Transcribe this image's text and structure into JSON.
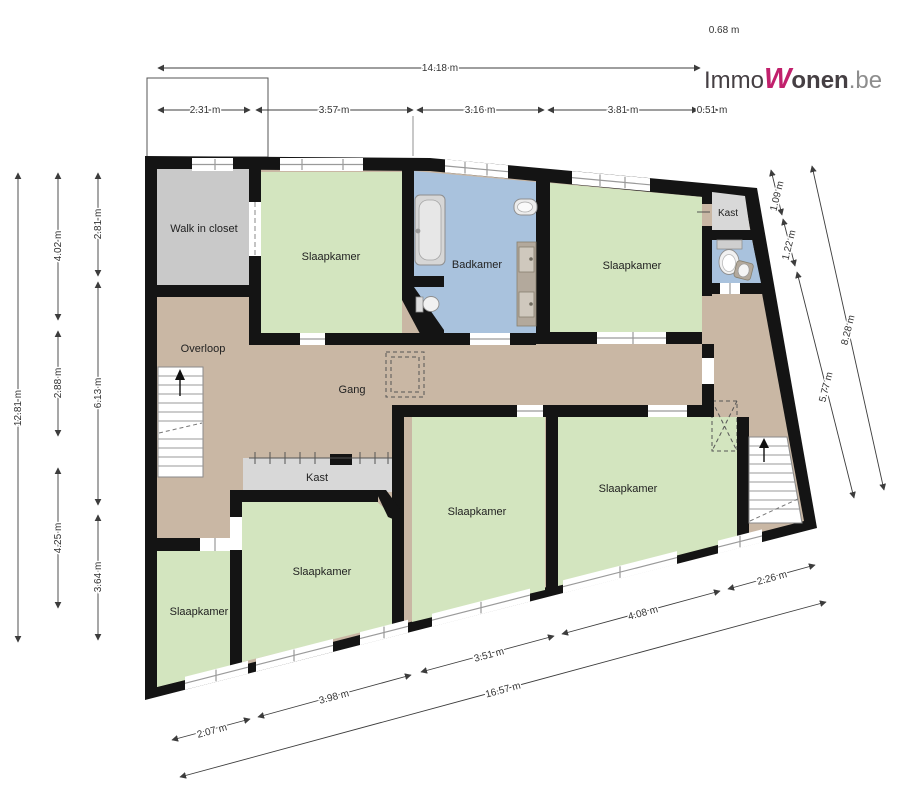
{
  "branding": {
    "immo": "Immo",
    "wonen_w": "W",
    "wonen_rest": "onen",
    "domain": ".be"
  },
  "room_labels": {
    "walk_in_closet": "Walk in closet",
    "slaapkamer": "Slaapkamer",
    "badkamer": "Badkamer",
    "overloop": "Overloop",
    "gang": "Gang",
    "kast": "Kast"
  },
  "dimensions": {
    "top_total": "14.18 m",
    "top_segments": [
      "2.31 m",
      "3.57 m",
      "3.16 m",
      "3.81 m",
      "0.51 m"
    ],
    "top_right_offset": "0.68 m",
    "left_total": "12.81 m",
    "left_col_a": [
      "4.02 m",
      "2.88 m",
      "4.25 m"
    ],
    "left_col_b": [
      "2.81 m",
      "6.13 m",
      "3.64 m"
    ],
    "right_inner": [
      "1.09 m",
      "1.22 m",
      "5.77 m"
    ],
    "right_outer": "8.28 m",
    "bottom_segments": [
      "2.07 m",
      "3.98 m",
      "3.51 m",
      "4.08 m",
      "2.26 m"
    ],
    "bottom_total": "16.57 m"
  },
  "colors": {
    "wall": "#141414",
    "hall_floor": "#c9b7a4",
    "bedroom": "#d3e5bf",
    "closet": "#c9c9c9",
    "bathroom": "#a9c2dd",
    "kast": "#d8d8d8",
    "skylight": "#bead98",
    "logo_accent": "#c1206c",
    "logo_dark": "#453f43",
    "logo_gray": "#8d8d8d"
  }
}
